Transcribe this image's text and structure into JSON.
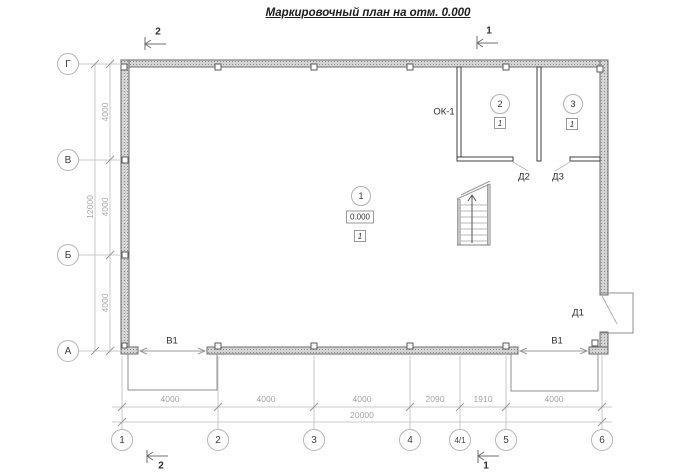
{
  "title": "Маркировочный план на отм. 0.000",
  "axes": {
    "cols": [
      {
        "label": "1"
      },
      {
        "label": "2"
      },
      {
        "label": "3"
      },
      {
        "label": "4"
      },
      {
        "label": "4/1"
      },
      {
        "label": "5"
      },
      {
        "label": "6"
      }
    ],
    "rows": [
      {
        "label": "Г"
      },
      {
        "label": "В"
      },
      {
        "label": "Б"
      },
      {
        "label": "А"
      }
    ]
  },
  "dimensions": {
    "bottom": [
      "4000",
      "4000",
      "4000",
      "2090",
      "1910",
      "4000"
    ],
    "bottom_total": "20000",
    "left": [
      "4000",
      "4000",
      "4000"
    ],
    "left_total": "12000"
  },
  "rooms": [
    {
      "number": "1",
      "level": "0.000",
      "floor_mark": "1"
    },
    {
      "number": "2",
      "floor_mark": "1"
    },
    {
      "number": "3",
      "floor_mark": "1"
    }
  ],
  "openings": {
    "window": "ОК-1",
    "door1": "Д1",
    "door2": "Д2",
    "door3": "Д3",
    "gate_left": "В1",
    "gate_right": "В1"
  },
  "sections": {
    "top_left": "2",
    "top_right": "1",
    "bottom_left": "2",
    "bottom_right": "1"
  },
  "colors": {
    "wall_fill": "#d4d4d4",
    "wall_stroke": "#6b6b6b",
    "dim_line": "#c9c9c9",
    "dim_text": "#a6a6a6",
    "thin_line": "#8f8f8f",
    "text": "#2e2e2e"
  }
}
